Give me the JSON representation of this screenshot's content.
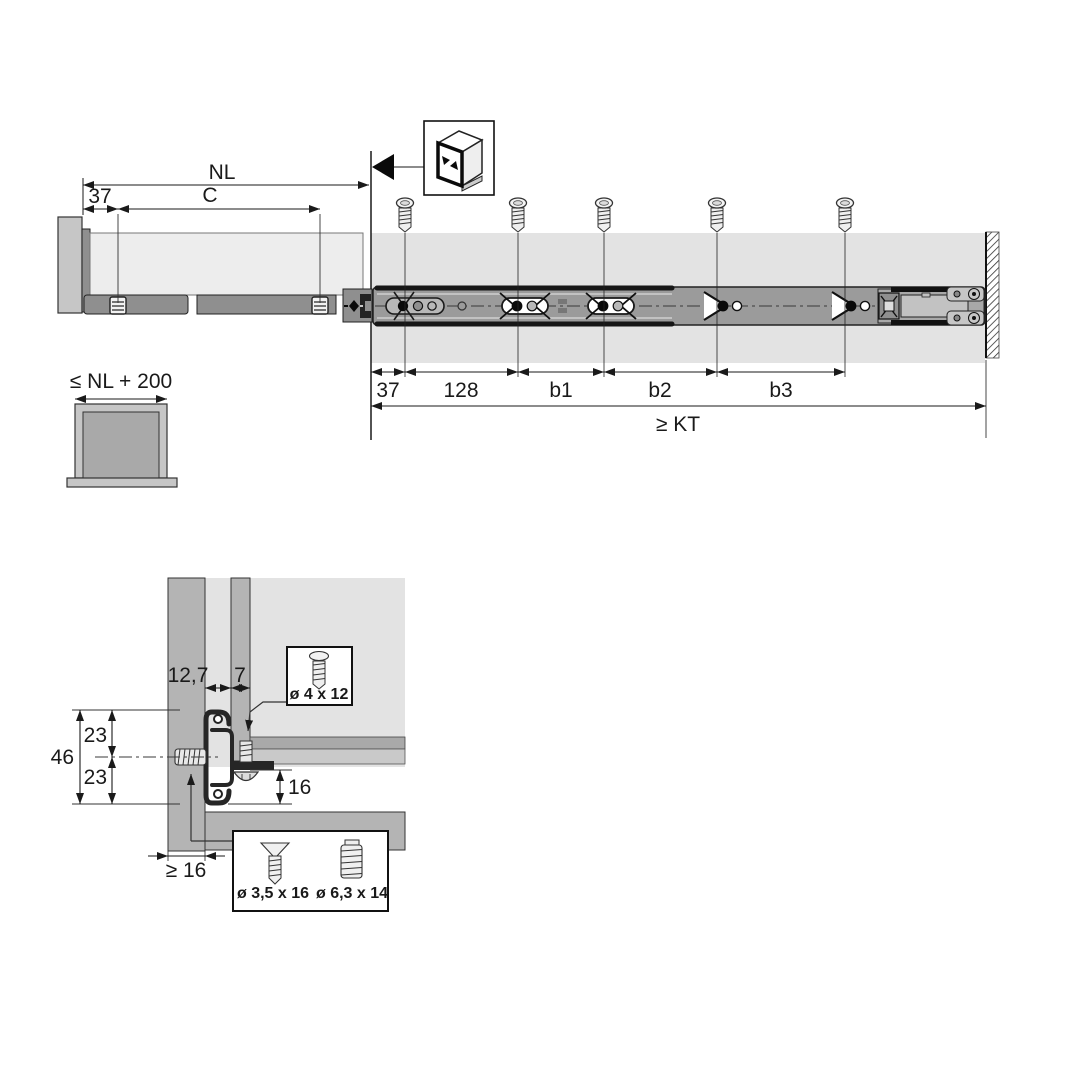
{
  "colors": {
    "text": "#1a1a1a",
    "outline": "#262626",
    "backdrop": "#e3e3e3",
    "panel": "#b4b4b4",
    "panel_dark": "#8f8f8f",
    "body": "#ededed",
    "rail": "#9b9b9b",
    "light": "#c6c6c6"
  },
  "top_view": {
    "nl_label": "NL",
    "front_offset": "37",
    "c_label": "C",
    "dims": {
      "d37": "37",
      "d128": "128",
      "b1": "b1",
      "b2": "b2",
      "b3": "b3",
      "kt": "≥ KT"
    }
  },
  "front_view": {
    "max_width_label": "≤ NL + 200"
  },
  "section_view": {
    "gap": "12,7",
    "side_offset": "7",
    "top_23": "23",
    "height_46": "46",
    "bottom_23": "23",
    "bottom_clearance": "16",
    "min_thickness": "≥ 16",
    "screw_top_label": "ø 4 x 12",
    "screw_wood_label": "ø 3,5 x 16",
    "screw_euro_label": "ø 6,3 x 14"
  }
}
